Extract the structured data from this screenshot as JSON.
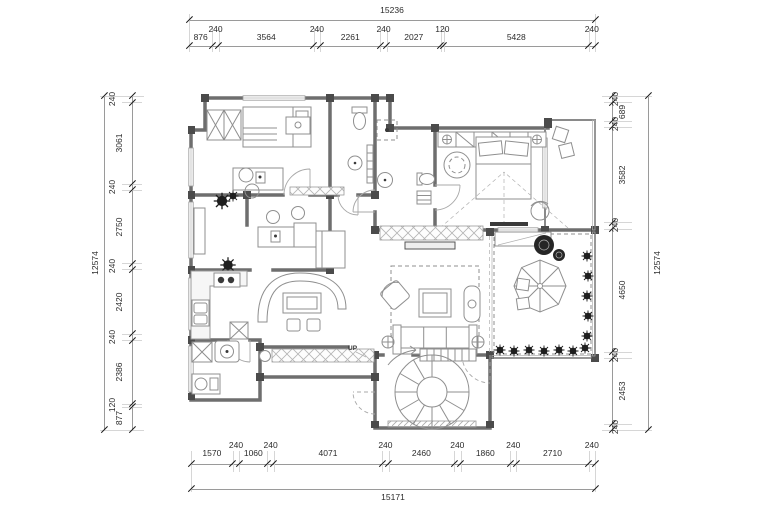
{
  "title": "Apartment floor plan with dimension chains",
  "labels": {
    "up": "UP"
  },
  "dimensions": {
    "top": {
      "total": "15236",
      "segments": [
        "876",
        "240",
        "3564",
        "240",
        "2261",
        "240",
        "2027",
        "120",
        "5428",
        "240"
      ]
    },
    "bottom": {
      "total": "15171",
      "segments": [
        "1570",
        "240",
        "1060",
        "240",
        "4071",
        "240",
        "2460",
        "240",
        "1860",
        "240",
        "2710",
        "240"
      ]
    },
    "left": {
      "total": "12574",
      "segments": [
        "240",
        "3061",
        "240",
        "2750",
        "240",
        "2420",
        "240",
        "2386",
        "120",
        "877"
      ]
    },
    "right": {
      "total": "12574",
      "segments": [
        "240",
        "689",
        "240",
        "3582",
        "240",
        "4650",
        "240",
        "2453",
        "240"
      ]
    }
  },
  "rooms": [
    "kids-bedroom",
    "bathroom",
    "master-bathroom",
    "master-bedroom",
    "balcony",
    "study",
    "hallway",
    "kitchen",
    "dining-area",
    "living-room",
    "utility-room",
    "corridor",
    "spiral-staircase",
    "terrace"
  ],
  "colors": {
    "wall": "#6e6e6e",
    "pier": "#4b4b4b",
    "furniture_line": "#8f8f8f",
    "dimension_text": "#2b2b2b",
    "plant": "#1e1e1e",
    "background": "#ffffff"
  }
}
